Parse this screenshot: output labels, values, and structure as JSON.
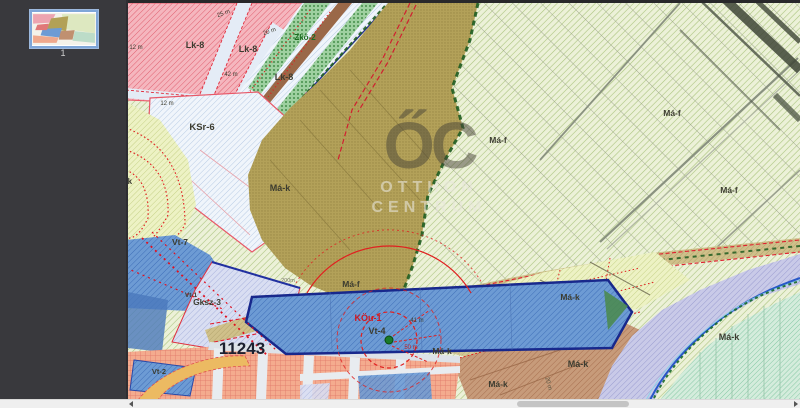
{
  "sidebar": {
    "page_number": "1"
  },
  "map": {
    "watermark": {
      "monogram": "ŐC",
      "line1": "OTTHON",
      "line2": "CENTRUM"
    },
    "label_default_color": "#3c3c30",
    "zone_labels": [
      {
        "text": "Lk-8",
        "x": 195,
        "y": 48,
        "size": 9
      },
      {
        "text": "Lk-8",
        "x": 248,
        "y": 52,
        "size": 9
      },
      {
        "text": "Lk-8",
        "x": 284,
        "y": 80,
        "size": 9
      },
      {
        "text": "Zkö-2",
        "x": 305,
        "y": 40,
        "size": 8,
        "color": "#1c6e22"
      },
      {
        "text": "KSr-6",
        "x": 202,
        "y": 130,
        "size": 9.5
      },
      {
        "text": "Má-k",
        "x": 123,
        "y": 184,
        "size": 8
      },
      {
        "text": "Má-k",
        "x": 280,
        "y": 191,
        "size": 9
      },
      {
        "text": "Vt-7",
        "x": 180,
        "y": 245,
        "size": 8.5
      },
      {
        "text": "Vt-1",
        "x": 191,
        "y": 297,
        "size": 6.5
      },
      {
        "text": "Gksz-3",
        "x": 207,
        "y": 305,
        "size": 8.5
      },
      {
        "text": "Vt-4",
        "x": 377,
        "y": 334,
        "size": 9
      },
      {
        "text": "Má-f",
        "x": 351,
        "y": 287,
        "size": 8.5
      },
      {
        "text": "KÖu-1",
        "x": 368,
        "y": 321,
        "size": 9,
        "color": "#d01820"
      },
      {
        "text": "Má-f",
        "x": 498,
        "y": 143,
        "size": 8.5
      },
      {
        "text": "Má-f",
        "x": 672,
        "y": 116,
        "size": 8.5
      },
      {
        "text": "Má-f",
        "x": 729,
        "y": 193,
        "size": 8.5
      },
      {
        "text": "Má-k",
        "x": 570,
        "y": 300,
        "size": 8.5
      },
      {
        "text": "Má-k",
        "x": 578,
        "y": 367,
        "size": 9
      },
      {
        "text": "Má-k",
        "x": 729,
        "y": 340,
        "size": 9
      },
      {
        "text": "Má-k",
        "x": 442,
        "y": 354,
        "size": 8.5
      },
      {
        "text": "Má-k",
        "x": 498,
        "y": 387,
        "size": 8.5
      },
      {
        "text": "Vt-2",
        "x": 159,
        "y": 374,
        "size": 7.5
      },
      {
        "text": "11243",
        "x": 242,
        "y": 354,
        "size": 17,
        "color": "#1c2030"
      }
    ],
    "dimension_labels": [
      {
        "text": "25 m",
        "x": 224,
        "y": 15,
        "size": 6,
        "rot": -20
      },
      {
        "text": "20 m",
        "x": 270,
        "y": 33,
        "size": 6,
        "rot": -20
      },
      {
        "text": "12 m",
        "x": 136,
        "y": 49,
        "size": 6
      },
      {
        "text": "42 m",
        "x": 231,
        "y": 76,
        "size": 6
      },
      {
        "text": "12 m",
        "x": 167,
        "y": 105,
        "size": 6
      },
      {
        "text": "200m",
        "x": 288,
        "y": 282,
        "size": 5.5,
        "color": "#777766"
      },
      {
        "text": "41 m",
        "x": 417,
        "y": 322,
        "size": 6
      },
      {
        "text": "50 m",
        "x": 411,
        "y": 349,
        "size": 6,
        "color": "#c02020"
      },
      {
        "text": "20 m",
        "x": 547,
        "y": 384,
        "size": 6,
        "rot": 75,
        "color": "#555544"
      }
    ],
    "colors": {
      "sidebar_bg": "#39393d",
      "thumb_border": "#7fa6d8",
      "zone_pink": "#f5b6be",
      "zone_olive": "#b3a159",
      "zone_light_green": "#ecf1d8",
      "zone_blue": "#6d9bd4",
      "zone_lavender": "#c9cae8",
      "zone_teal": "#d4ecdc",
      "zone_brown": "#c79b7a",
      "zone_orange": "#f4ab8e",
      "zone_yellow_green": "#edf2c4",
      "road_khaki": "#cfc08a",
      "boundary_green": "#1e5c20",
      "boundary_red": "#e02030",
      "scroll_track": "#efefef",
      "scroll_thumb": "#c4c4c4"
    }
  }
}
